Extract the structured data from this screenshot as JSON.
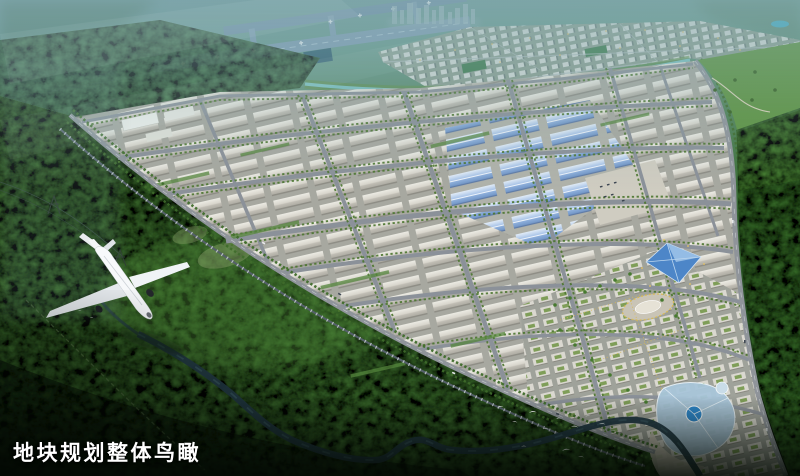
{
  "scene": {
    "caption": "地块规划整体鸟瞰",
    "colors": {
      "haze_teal": "#6f9aa3",
      "forest_dark": "#16240f",
      "forest_mid": "#3d6a33",
      "forest_bright": "#4c8a33",
      "park_ground": "#a7a8a0",
      "warehouse_roof": "#d9d6cd",
      "blue_roof": "#8fb2e2",
      "road_grey": "#8b9199",
      "river_blue": "#27404d",
      "runway_grey": "#7e9db5",
      "landmark_blue": "#4d86c8",
      "street_light_yellow": "#d9b954",
      "caption_white": "#ffffff"
    },
    "icons": {
      "airplane_icon": "svg-shape",
      "birds_icon": "svg-chevrons",
      "runway_strip": "svg-shape",
      "river_path": "svg-path"
    }
  }
}
